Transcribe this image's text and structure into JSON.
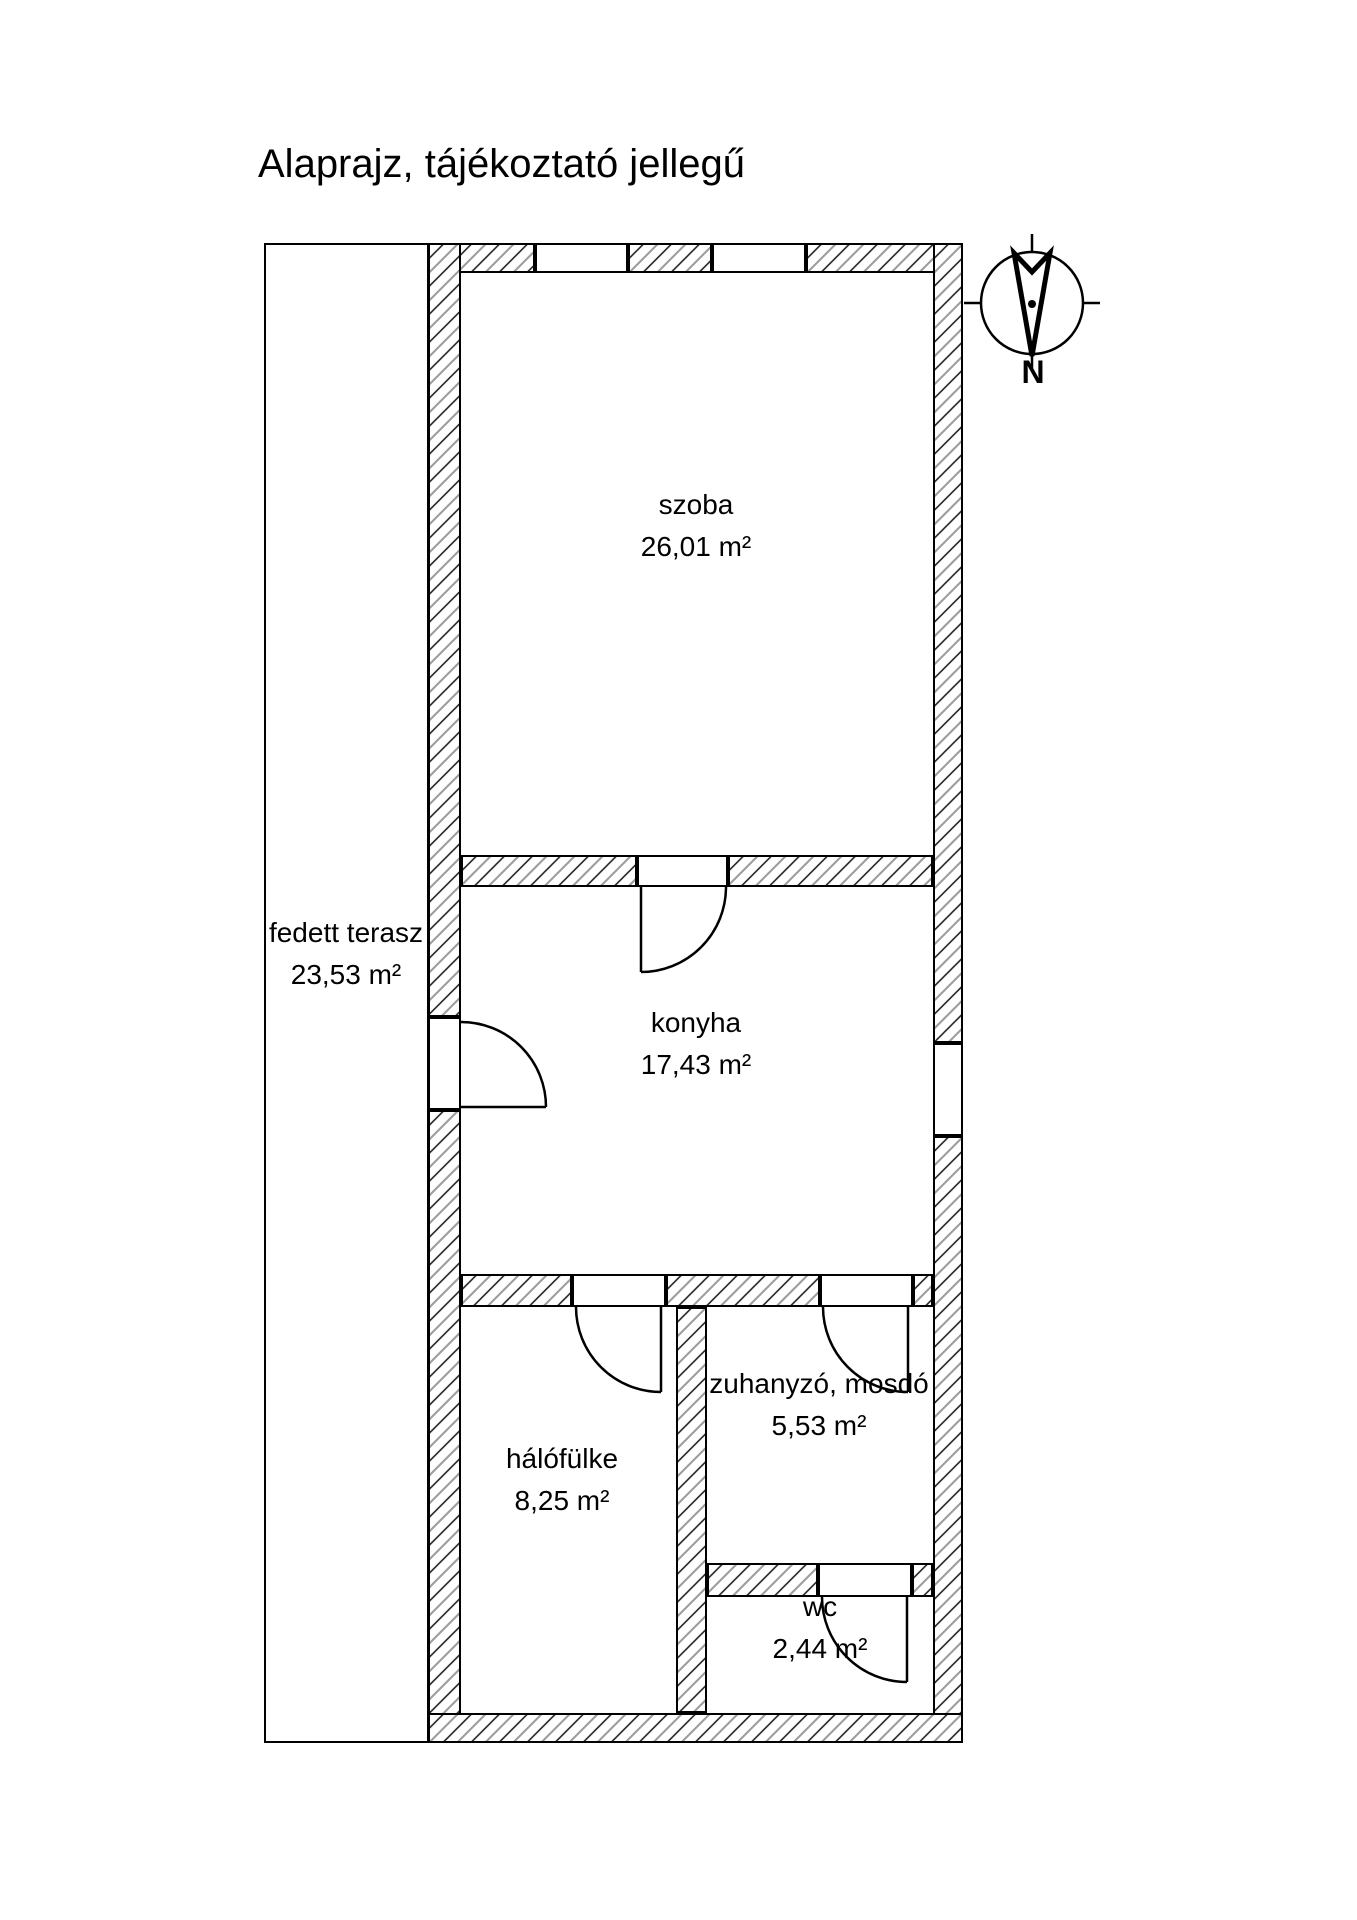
{
  "title": "Alaprajz, tájékoztató jellegű",
  "compass": {
    "north_label": "N"
  },
  "rooms": {
    "terasz": {
      "name": "fedett terasz",
      "area": "23,53 m²"
    },
    "szoba": {
      "name": "szoba",
      "area": "26,01 m²"
    },
    "konyha": {
      "name": "konyha",
      "area": "17,43 m²"
    },
    "halofulke": {
      "name": "hálófülke",
      "area": "8,25 m²"
    },
    "zuhanyzo": {
      "name": "zuhanyzó, mosdó",
      "area": "5,53 m²"
    },
    "wc": {
      "name": "wc",
      "area": "2,44 m²"
    }
  }
}
